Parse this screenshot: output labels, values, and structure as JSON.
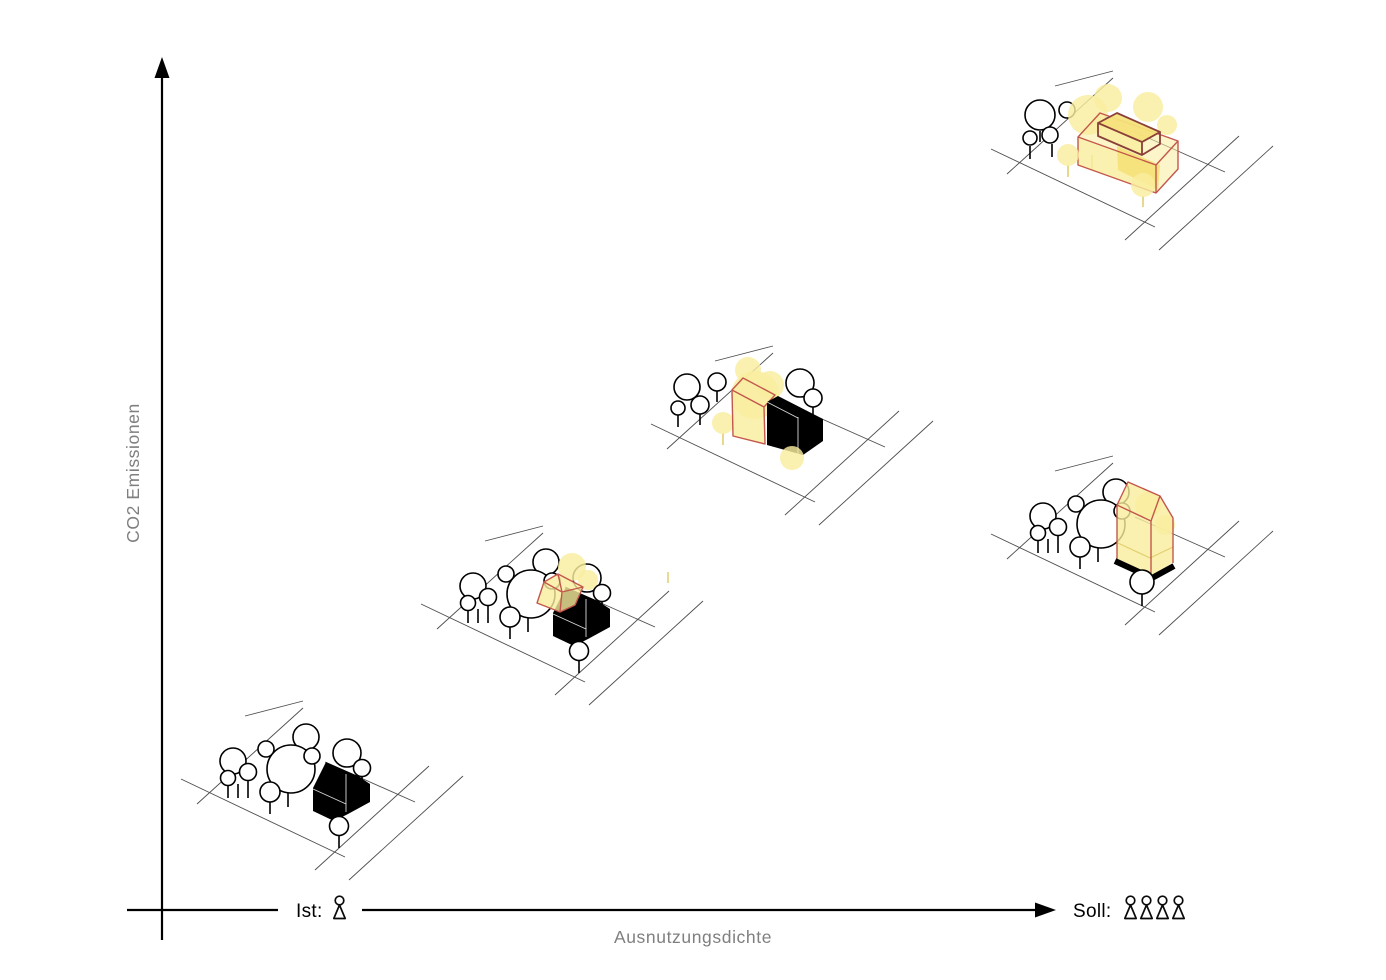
{
  "canvas": {
    "width": 1386,
    "height": 980,
    "background": "#ffffff"
  },
  "axes": {
    "y_label": "CO2 Emissionen",
    "x_label": "Ausnutzungsdichte"
  },
  "legend": {
    "ist_label": "Ist:",
    "ist_person_count": 1,
    "soll_label": "Soll:",
    "soll_person_count": 4
  },
  "icons": {
    "person": "person-icon",
    "y_arrow": "arrow-up-icon",
    "x_arrow": "arrow-right-icon"
  },
  "colors": {
    "axis-black": "#000000",
    "site-line": "#4d4d4d",
    "tree-outline": "#000000",
    "house-black": "#000000",
    "new-yellow": "#F9ED9E",
    "new-yellow-deep": "#F5E27A",
    "new-yellow-line": "#E2CF6E",
    "new-red": "#C4574C",
    "new-red-dark": "#8A4038",
    "label-gray": "#7f7f7f"
  },
  "scenarios": [
    {
      "id": "existing-black-house",
      "transform": "translate(175,700)"
    },
    {
      "id": "house-with-roof-addition",
      "transform": "translate(415,525)"
    },
    {
      "id": "house-with-side-addition",
      "transform": "translate(645,345)"
    },
    {
      "id": "new-slab-volume",
      "transform": "translate(985,70)"
    },
    {
      "id": "new-tower-volume",
      "transform": "translate(985,455)"
    }
  ]
}
